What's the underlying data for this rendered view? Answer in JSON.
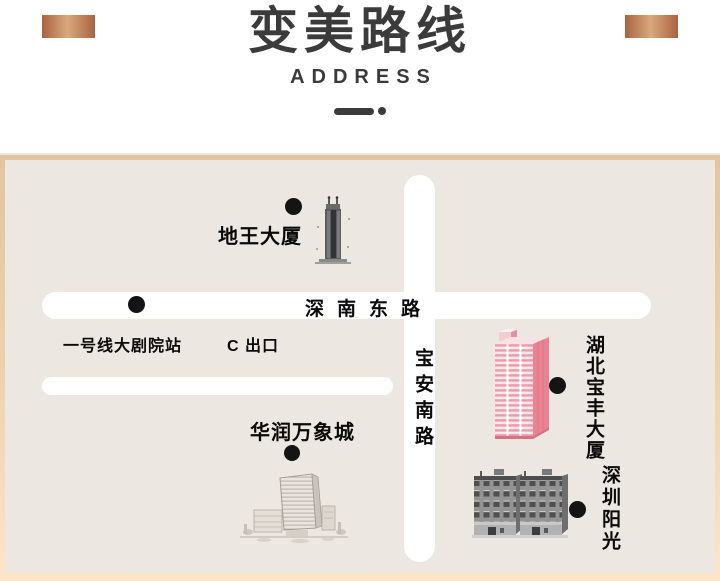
{
  "header": {
    "title": "变美路线",
    "subtitle": "ADDRESS"
  },
  "map": {
    "road_horizontal": "深南东路",
    "road_vertical": "宝安南路",
    "labels": {
      "diwang": "地王大厦",
      "station": "一号线大剧院站",
      "exit": "C 出口",
      "baofeng": "湖北宝丰大厦",
      "mixc": "华润万象城",
      "sunshine": "深圳阳光"
    }
  },
  "colors": {
    "title_text": "#3b3b3b",
    "copper_dark": "#a96340",
    "copper_light": "#d9a87c",
    "frame_top": "#e3c49c",
    "frame_bottom": "#fde5c8",
    "map_background": "#ece7e0",
    "road": "#ffffff",
    "label_text": "#0a0a0a",
    "marker_dot": "#141414",
    "baofeng_front": "#fbe9ec",
    "baofeng_stripe": "#ec9aa8",
    "baofeng_side": "#ea8495",
    "sunshine_face": "#939393",
    "sunshine_side": "#6e6e6e"
  }
}
